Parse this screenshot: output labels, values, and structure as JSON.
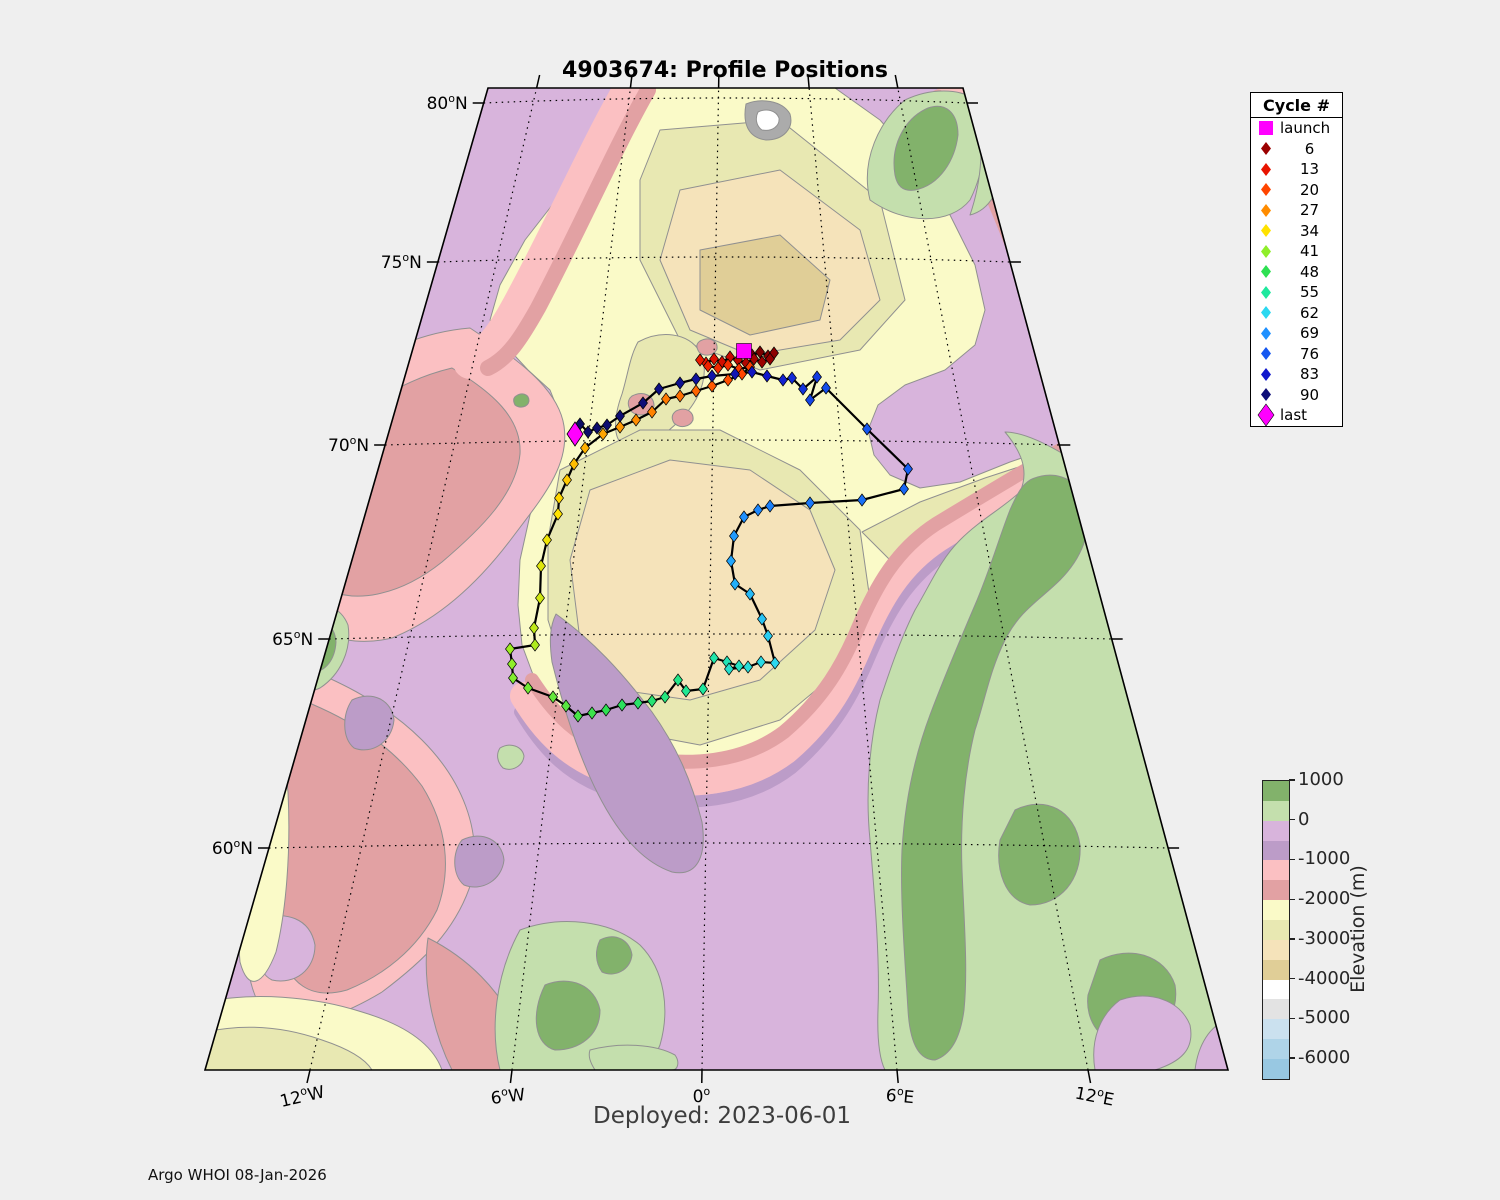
{
  "title": "4903674: Profile Positions",
  "deployed_text": "Deployed: 2023-06-01",
  "credit_text": "Argo WHOI 08-Jan-2026",
  "legend": {
    "header": "Cycle #",
    "entries": [
      {
        "marker": "square",
        "color": "#FF00FF",
        "label": "launch"
      },
      {
        "marker": "diamond",
        "color": "#9B0000",
        "label": "6"
      },
      {
        "marker": "diamond",
        "color": "#E81400",
        "label": "13"
      },
      {
        "marker": "diamond",
        "color": "#FF4500",
        "label": "20"
      },
      {
        "marker": "diamond",
        "color": "#FF8C00",
        "label": "27"
      },
      {
        "marker": "diamond",
        "color": "#FFE200",
        "label": "34"
      },
      {
        "marker": "diamond",
        "color": "#8FEE2A",
        "label": "41"
      },
      {
        "marker": "diamond",
        "color": "#2EE052",
        "label": "48"
      },
      {
        "marker": "diamond",
        "color": "#1FE89E",
        "label": "55"
      },
      {
        "marker": "diamond",
        "color": "#2BD8F0",
        "label": "62"
      },
      {
        "marker": "diamond",
        "color": "#1E90FF",
        "label": "69"
      },
      {
        "marker": "diamond",
        "color": "#1557F0",
        "label": "76"
      },
      {
        "marker": "diamond",
        "color": "#1118CC",
        "label": "83"
      },
      {
        "marker": "diamond",
        "color": "#0E0E78",
        "label": "90"
      },
      {
        "marker": "diamond-large",
        "color": "#FF00FF",
        "label": "last"
      }
    ]
  },
  "colorbar": {
    "title": "Elevation (m)",
    "segment_colors": [
      "#82B26B",
      "#C4DFAD",
      "#D8B4DC",
      "#BC9CC8",
      "#FBC0C2",
      "#E2A1A3",
      "#FAFAC8",
      "#E8E8B2",
      "#F5E3BA",
      "#E0CE97",
      "#FFFFFF",
      "#E3E3E3",
      "#CBE1EF",
      "#AFD4E8",
      "#98C8E2"
    ],
    "ticks": [
      {
        "label": "1000",
        "pos": 0
      },
      {
        "label": "0",
        "pos": 2
      },
      {
        "label": "-1000",
        "pos": 4
      },
      {
        "label": "-2000",
        "pos": 6
      },
      {
        "label": "-3000",
        "pos": 8
      },
      {
        "label": "-4000",
        "pos": 10
      },
      {
        "label": "-5000",
        "pos": 12
      },
      {
        "label": "-6000",
        "pos": 14
      }
    ]
  },
  "palette": {
    "lilac": "#D8B4DC",
    "purple": "#BC9CC8",
    "pink": "#FBC0C2",
    "rose": "#E2A1A3",
    "paleYellow": "#FAFAC8",
    "khaki": "#E8E8B2",
    "tanLight": "#F5E3BA",
    "tanDark": "#E0CE97",
    "white": "#FFFFFF",
    "gray": "#ABABAB",
    "greenLight": "#C4DFAD",
    "greenDark": "#82B26B",
    "contour": "#909090",
    "graticule": "#000000",
    "trackline": "#000000"
  },
  "graticule": {
    "parallels": [
      {
        "deg": "80",
        "hemi": "N",
        "y": 103
      },
      {
        "deg": "75",
        "hemi": "N",
        "y": 262
      },
      {
        "deg": "70",
        "hemi": "N",
        "y": 445
      },
      {
        "deg": "65",
        "hemi": "N",
        "y": 639
      },
      {
        "deg": "60",
        "hemi": "N",
        "y": 848
      }
    ],
    "meridians": [
      {
        "deg": "12",
        "hemi": "W",
        "x": 310
      },
      {
        "deg": "6",
        "hemi": "W",
        "x": 512
      },
      {
        "deg": "0",
        "hemi": "",
        "x": 702
      },
      {
        "deg": "6",
        "hemi": "E",
        "x": 897
      },
      {
        "deg": "12",
        "hemi": "E",
        "x": 1088
      }
    ]
  },
  "chart_data": {
    "type": "map-trajectory",
    "float_id": "4903674",
    "deployed": "2023-06-01",
    "colormap_anchors": [
      {
        "c": 0,
        "color": "#6E0000"
      },
      {
        "c": 6,
        "color": "#9B0000"
      },
      {
        "c": 13,
        "color": "#E81400"
      },
      {
        "c": 20,
        "color": "#FF4500"
      },
      {
        "c": 27,
        "color": "#FF8C00"
      },
      {
        "c": 34,
        "color": "#FFE200"
      },
      {
        "c": 41,
        "color": "#8FEE2A"
      },
      {
        "c": 48,
        "color": "#2EE052"
      },
      {
        "c": 55,
        "color": "#1FE89E"
      },
      {
        "c": 62,
        "color": "#2BD8F0"
      },
      {
        "c": 69,
        "color": "#1E90FF"
      },
      {
        "c": 76,
        "color": "#1557F0"
      },
      {
        "c": 83,
        "color": "#1118CC"
      },
      {
        "c": 90,
        "color": "#0E0E78"
      },
      {
        "c": 96,
        "color": "#0B0B60"
      }
    ],
    "launch": {
      "x": 744,
      "y": 351,
      "color": "#FF00FF"
    },
    "last": {
      "x": 575,
      "y": 434,
      "color": "#FF00FF"
    },
    "trajectory": [
      [
        1,
        752,
        355
      ],
      [
        2,
        760,
        352
      ],
      [
        3,
        768,
        356
      ],
      [
        4,
        774,
        353
      ],
      [
        5,
        770,
        359
      ],
      [
        6,
        762,
        362
      ],
      [
        7,
        754,
        359
      ],
      [
        8,
        746,
        363
      ],
      [
        9,
        738,
        360
      ],
      [
        10,
        730,
        357
      ],
      [
        11,
        722,
        362
      ],
      [
        12,
        714,
        359
      ],
      [
        13,
        706,
        363
      ],
      [
        14,
        700,
        360
      ],
      [
        15,
        708,
        366
      ],
      [
        16,
        718,
        368
      ],
      [
        17,
        728,
        365
      ],
      [
        18,
        739,
        369
      ],
      [
        19,
        750,
        367
      ],
      [
        20,
        742,
        374
      ],
      [
        21,
        728,
        380
      ],
      [
        22,
        712,
        386
      ],
      [
        23,
        696,
        391
      ],
      [
        24,
        680,
        396
      ],
      [
        25,
        666,
        399
      ],
      [
        26,
        652,
        412
      ],
      [
        27,
        636,
        420
      ],
      [
        28,
        620,
        427
      ],
      [
        29,
        603,
        434
      ],
      [
        30,
        585,
        448
      ],
      [
        31,
        574,
        464
      ],
      [
        32,
        567,
        480
      ],
      [
        33,
        559,
        498
      ],
      [
        34,
        558,
        514
      ],
      [
        35,
        547,
        540
      ],
      [
        36,
        541,
        566
      ],
      [
        37,
        540,
        598
      ],
      [
        38,
        534,
        628
      ],
      [
        39,
        535,
        645
      ],
      [
        40,
        510,
        649
      ],
      [
        41,
        512,
        664
      ],
      [
        42,
        513,
        678
      ],
      [
        43,
        528,
        688
      ],
      [
        44,
        553,
        697
      ],
      [
        45,
        566,
        706
      ],
      [
        46,
        578,
        716
      ],
      [
        47,
        592,
        713
      ],
      [
        48,
        606,
        710
      ],
      [
        49,
        622,
        705
      ],
      [
        50,
        638,
        703
      ],
      [
        51,
        652,
        701
      ],
      [
        52,
        665,
        697
      ],
      [
        53,
        678,
        680
      ],
      [
        54,
        686,
        691
      ],
      [
        55,
        703,
        689
      ],
      [
        56,
        714,
        658
      ],
      [
        57,
        727,
        662
      ],
      [
        58,
        739,
        666
      ],
      [
        59,
        729,
        669
      ],
      [
        60,
        748,
        667
      ],
      [
        61,
        761,
        662
      ],
      [
        62,
        775,
        663
      ],
      [
        63,
        768,
        636
      ],
      [
        64,
        762,
        619
      ],
      [
        65,
        750,
        594
      ],
      [
        66,
        735,
        584
      ],
      [
        67,
        731,
        561
      ],
      [
        68,
        734,
        536
      ],
      [
        69,
        744,
        517
      ],
      [
        70,
        758,
        510
      ],
      [
        71,
        770,
        506
      ],
      [
        72,
        810,
        503
      ],
      [
        73,
        862,
        500
      ],
      [
        74,
        904,
        489
      ],
      [
        75,
        908,
        469
      ],
      [
        76,
        867,
        429
      ],
      [
        77,
        826,
        388
      ],
      [
        78,
        810,
        400
      ],
      [
        79,
        817,
        377
      ],
      [
        80,
        803,
        389
      ],
      [
        81,
        792,
        378
      ],
      [
        82,
        783,
        380
      ],
      [
        83,
        767,
        376
      ],
      [
        84,
        752,
        372
      ],
      [
        85,
        735,
        374
      ],
      [
        86,
        712,
        376
      ],
      [
        87,
        696,
        379
      ],
      [
        88,
        680,
        383
      ],
      [
        89,
        659,
        389
      ],
      [
        90,
        643,
        403
      ],
      [
        91,
        620,
        416
      ],
      [
        92,
        607,
        425
      ],
      [
        93,
        597,
        428
      ],
      [
        94,
        588,
        432
      ],
      [
        95,
        580,
        424
      ],
      [
        96,
        576,
        437
      ]
    ]
  }
}
